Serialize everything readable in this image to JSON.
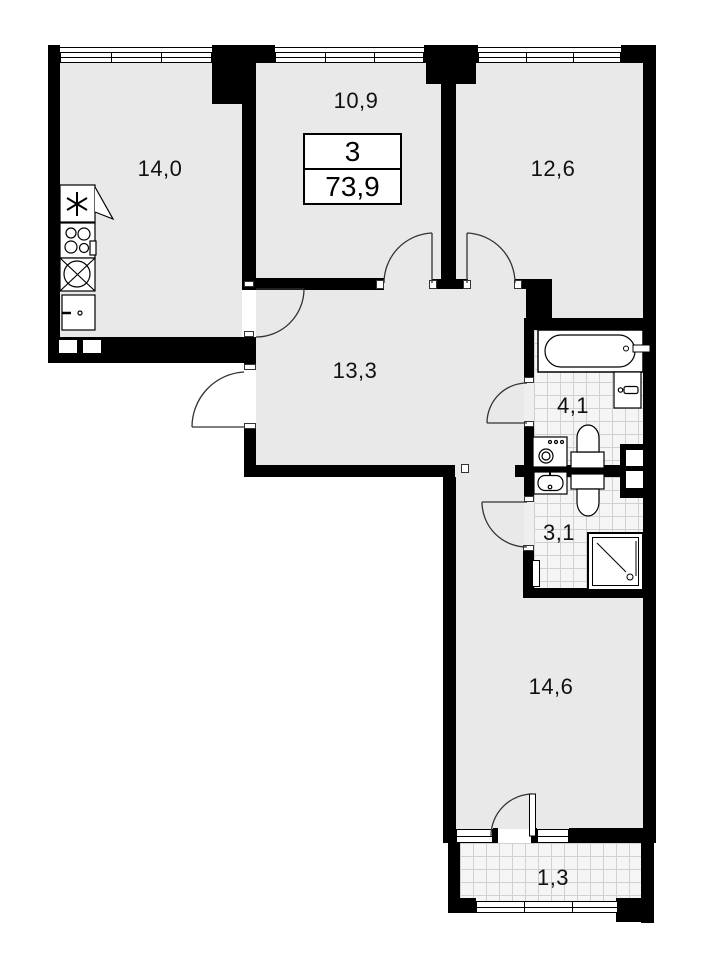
{
  "spec_box": {
    "rooms_count": "3",
    "total_area": "73,9"
  },
  "rooms": {
    "kitchen_living": "14,0",
    "bedroom_top": "10,9",
    "bedroom_right": "12,6",
    "hallway": "13,3",
    "bathroom": "4,1",
    "toilet": "3,1",
    "bedroom_bottom": "14,6",
    "balcony": "1,3"
  },
  "icons": {
    "vent": "six-spoke-asterisk",
    "kitchen": [
      "vent-icon",
      "stove-icon",
      "kitchen-sink-icon",
      "kitchen-cabinet-icon"
    ],
    "bathroom": [
      "bathtub-icon",
      "washbasin-icon",
      "toilet-icon",
      "washing-machine-icon",
      "vent-duct-icon"
    ],
    "toilet_room": [
      "washbasin-icon",
      "toilet-icon",
      "shower-icon"
    ],
    "other": [
      "door-arc-icon",
      "window-icon"
    ]
  },
  "colors": {
    "wall": "#000000",
    "room_fill": "#e9e9e9",
    "tile_fill": "#f5f5f5",
    "tile_line": "#d0d0d0",
    "door_line": "#333333"
  }
}
